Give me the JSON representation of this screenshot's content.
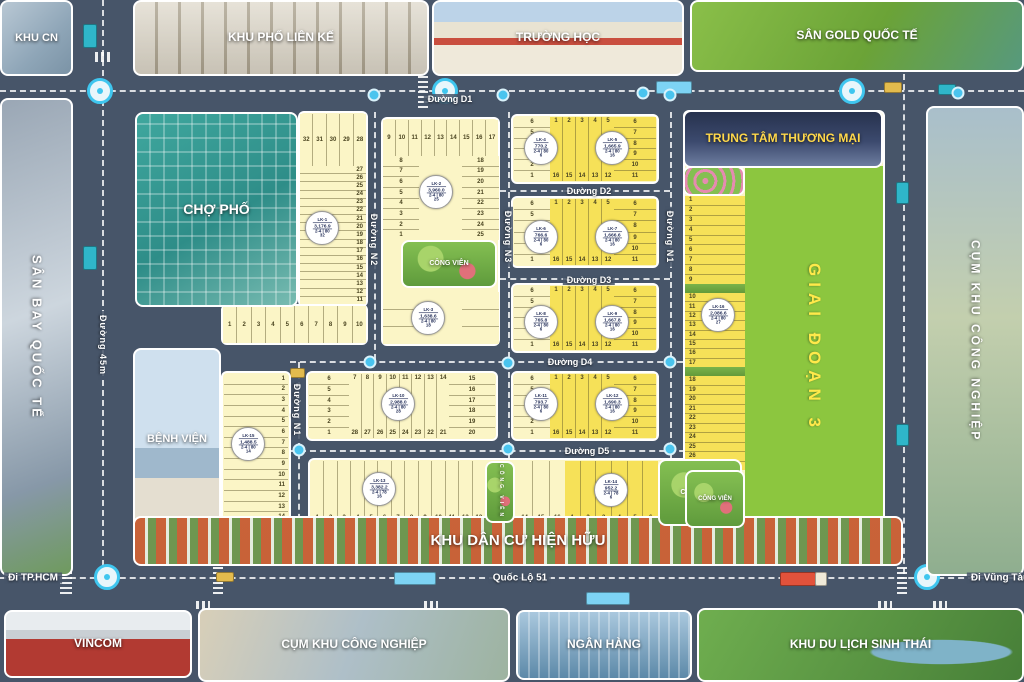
{
  "colors": {
    "road": "#475569",
    "lot_cream": "#fbf5c6",
    "lot_bright": "#f6e158",
    "phase_green": "#8cc63f",
    "phase_text": "#ffe94a",
    "accent_cyan": "#3fc6ef",
    "tttm_label": "#ffd84a",
    "label_white": "#ffffff"
  },
  "photos": {
    "khu_cn": {
      "label": "KHU CN"
    },
    "khu_pho_lien_ke": {
      "label": "KHU PHỐ LIÊN KẾ"
    },
    "truong_hoc": {
      "label": "TRƯỜNG HỌC"
    },
    "san_gold": {
      "label": "SÂN GOLD QUỐC TẾ"
    },
    "san_bay": {
      "label": "SÂN BAY QUỐC TẾ"
    },
    "cho_pho": {
      "label": "CHỢ PHỐ"
    },
    "benh_vien": {
      "label": "BỆNH VIỆN"
    },
    "tttm": {
      "label": "TRUNG TÂM THƯƠNG MẠI"
    },
    "cum_kcn_right": {
      "label": "CỤM KHU CÔNG NGHIỆP"
    },
    "khu_dan_cu": {
      "label": "KHU DÂN CƯ HIỆN HỮU"
    },
    "vincom": {
      "label": "VINCOM"
    },
    "cum_kcn_bottom": {
      "label": "CỤM KHU CÔNG NGHIỆP"
    },
    "ngan_hang": {
      "label": "NGÂN HÀNG"
    },
    "du_lich": {
      "label": "KHU DU LỊCH SINH THÁI"
    },
    "cong_vien_b": {
      "label": "CÔNG VIÊN"
    },
    "cong_vien_h": {
      "label": "CÔNG VIÊN"
    },
    "cong_vien_j": {
      "label": "CÔNG VIÊN"
    },
    "cong_vien_s": {
      "label": "CÔNG VIÊN"
    },
    "flower_park": {
      "label": ""
    }
  },
  "phase3": {
    "label": "GIAI ĐOẠN 3"
  },
  "roads": {
    "d1": "Đường D1",
    "d2": "Đường D2",
    "d3": "Đường D3",
    "d4": "Đường D4",
    "d5": "Đường D5",
    "n1_left": "Đường N1",
    "n1_right": "Đường N1",
    "n2": "Đường N2",
    "n3": "Đường N3",
    "r45": "Đường 45m",
    "ql51": "Quốc Lộ 51",
    "di_hcm": "Đi TP.HCM",
    "di_vungtau": "Đi Vũng Tàu"
  },
  "strips": {
    "a_top": {
      "nums": [
        "32",
        "31",
        "30",
        "29",
        "28"
      ]
    },
    "a_col": {
      "nums": [
        "27",
        "26",
        "25",
        "24",
        "23",
        "22",
        "21",
        "20",
        "19",
        "18",
        "17",
        "16",
        "15",
        "14",
        "13",
        "12",
        "11"
      ]
    },
    "a_bottom": {
      "nums": [
        "1",
        "2",
        "3",
        "4",
        "5",
        "6",
        "7",
        "8",
        "9",
        "10"
      ]
    },
    "b_top": {
      "nums": [
        "9",
        "10",
        "11",
        "12",
        "13",
        "14",
        "15",
        "16",
        "17"
      ]
    },
    "b_left": {
      "nums": [
        "8",
        "7",
        "6",
        "5",
        "4",
        "3",
        "2",
        "1"
      ]
    },
    "b_right": {
      "nums": [
        "18",
        "19",
        "20",
        "21",
        "22",
        "23",
        "24",
        "25"
      ]
    },
    "b_lower_l": {
      "nums": [
        "",
        "",
        ""
      ]
    },
    "b_lower_r": {
      "nums": [
        "",
        "",
        ""
      ]
    },
    "c_left": {
      "nums": [
        "6",
        "5",
        "4",
        "3",
        "2",
        "1"
      ]
    },
    "c_mid": {
      "tops": [
        "1",
        "2",
        "3",
        "4",
        "5"
      ],
      "bottoms": [
        "16",
        "15",
        "14",
        "13",
        "12"
      ]
    },
    "c_right": {
      "nums": [
        "6",
        "7",
        "8",
        "9",
        "10",
        "11"
      ]
    },
    "d_left": {
      "nums": [
        "6",
        "5",
        "4",
        "3",
        "2",
        "1"
      ]
    },
    "d_mid": {
      "tops": [
        "1",
        "2",
        "3",
        "4",
        "5"
      ],
      "bottoms": [
        "16",
        "15",
        "14",
        "13",
        "12"
      ]
    },
    "d_right": {
      "nums": [
        "6",
        "7",
        "8",
        "9",
        "10",
        "11"
      ]
    },
    "e_left": {
      "nums": [
        "6",
        "5",
        "4",
        "3",
        "2",
        "1"
      ]
    },
    "e_mid": {
      "tops": [
        "1",
        "2",
        "3",
        "4",
        "5"
      ],
      "bottoms": [
        "16",
        "15",
        "14",
        "13",
        "12"
      ]
    },
    "e_right": {
      "nums": [
        "6",
        "7",
        "8",
        "9",
        "10",
        "11"
      ]
    },
    "f_left": {
      "nums": [
        "6",
        "5",
        "4",
        "3",
        "2",
        "1"
      ]
    },
    "f_mid": {
      "tops": [
        "7",
        "8",
        "9",
        "10",
        "11",
        "12",
        "13",
        "14"
      ],
      "bottoms": [
        "28",
        "27",
        "26",
        "25",
        "24",
        "23",
        "22",
        "21"
      ]
    },
    "f_right": {
      "nums": [
        "15",
        "16",
        "17",
        "18",
        "19",
        "20"
      ]
    },
    "g_left": {
      "nums": [
        "6",
        "5",
        "4",
        "3",
        "2",
        "1"
      ]
    },
    "g_mid": {
      "tops": [
        "1",
        "2",
        "3",
        "4",
        "5"
      ],
      "bottoms": [
        "16",
        "15",
        "14",
        "13",
        "12"
      ]
    },
    "g_right": {
      "nums": [
        "6",
        "7",
        "8",
        "9",
        "10",
        "11"
      ]
    },
    "h_seg1": {
      "nums": [
        "1",
        "2",
        "3",
        "4",
        "5",
        "6",
        "7",
        "8",
        "9",
        "10",
        "11",
        "12",
        "13"
      ]
    },
    "h_seg2": {
      "nums": [
        "14",
        "15",
        "16"
      ]
    },
    "h_seg3": {
      "nums": [
        "1",
        "2",
        "3",
        "4",
        "5",
        "6"
      ]
    },
    "i_col": {
      "nums": [
        "1",
        "2",
        "3",
        "4",
        "5",
        "6",
        "7",
        "8",
        "9",
        "10",
        "11",
        "12",
        "13",
        "14"
      ]
    },
    "j1": {
      "nums": [
        "1",
        "2",
        "3",
        "4",
        "5",
        "6",
        "7",
        "8",
        "9"
      ]
    },
    "j2": {
      "nums": [
        "10",
        "11",
        "12",
        "13",
        "14",
        "15",
        "16",
        "17"
      ]
    },
    "j3": {
      "nums": [
        "18",
        "19",
        "20",
        "21",
        "22",
        "23",
        "24",
        "25",
        "26",
        "27"
      ]
    }
  },
  "badges": {
    "b1": {
      "code": "LK-1",
      "area": "3,176.9",
      "size": "2-4 | 80",
      "count": "32"
    },
    "b2": {
      "code": "LK-2",
      "area": "3,960.0",
      "size": "2-4 | 80",
      "count": "25"
    },
    "b3": {
      "code": "LK-3",
      "area": "1,638.6",
      "size": "2-4 | 80",
      "count": "18"
    },
    "b4": {
      "code": "LK-4",
      "area": "770.2",
      "size": "2-4 | 80",
      "count": "6"
    },
    "b5": {
      "code": "LK-5",
      "area": "1,665.9",
      "size": "2-4 | 80",
      "count": "16"
    },
    "b6": {
      "code": "LK-6",
      "area": "766.6",
      "size": "2-4 | 80",
      "count": "6"
    },
    "b7": {
      "code": "LK-7",
      "area": "1,666.6",
      "size": "2-4 | 80",
      "count": "16"
    },
    "b8": {
      "code": "LK-8",
      "area": "765.8",
      "size": "2-4 | 80",
      "count": "6"
    },
    "b9": {
      "code": "LK-9",
      "area": "1,667.8",
      "size": "2-4 | 80",
      "count": "16"
    },
    "b10": {
      "code": "LK-10",
      "area": "2,988.0",
      "size": "2-4 | 80",
      "count": "28"
    },
    "b11": {
      "code": "LK-11",
      "area": "793.7",
      "size": "2-4 | 80",
      "count": "6"
    },
    "b12": {
      "code": "LK-12",
      "area": "1,690.3",
      "size": "2-4 | 80",
      "count": "16"
    },
    "b13": {
      "code": "LK-13",
      "area": "3,382.2",
      "size": "2-4 | 78",
      "count": "16"
    },
    "b14": {
      "code": "LK-14",
      "area": "952.2",
      "size": "2-4 | 78",
      "count": "6"
    },
    "b15": {
      "code": "LK-15",
      "area": "1,488.5",
      "size": "2-4 | 80",
      "count": "14"
    },
    "b16": {
      "code": "LK-16",
      "area": "2,086.6",
      "size": "2-4 | 80",
      "count": "27"
    }
  }
}
